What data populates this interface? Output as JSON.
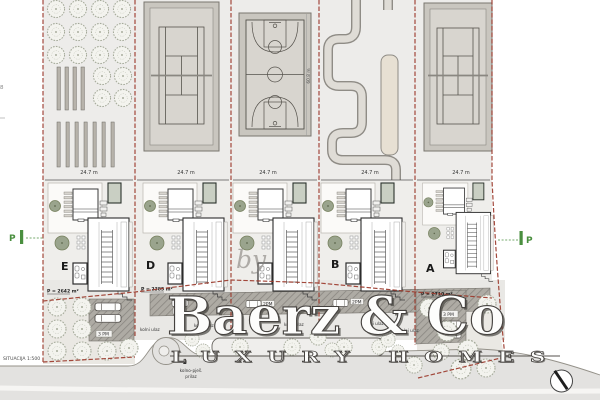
{
  "scale_label": "SITUACIJA 1:500",
  "dims": {
    "plot_width": "24.7 m",
    "court_depth": "60.8 m"
  },
  "plots": [
    {
      "id": "E",
      "label": "E",
      "area": "P = 2642 m²"
    },
    {
      "id": "D",
      "label": "D",
      "area": "P = 2385 m²"
    },
    {
      "id": "C",
      "label": "",
      "area": ""
    },
    {
      "id": "B",
      "label": "B",
      "area": ""
    },
    {
      "id": "A",
      "label": "A",
      "area": "P = 2710 m²"
    }
  ],
  "parking": {
    "marker": "P",
    "two": "2PM",
    "three": "3 PM"
  },
  "road_labels": {
    "driveway": "kolni ulaz",
    "access_1": "kolno-pješ.",
    "access_2": "prilaz"
  },
  "watermark": {
    "by": "by",
    "brand": "Baerz & Co",
    "tagline": "LUXURY HOMES"
  },
  "edge_fragment": "8",
  "colors": {
    "boundary_red": "#9c3a2c",
    "parking_green": "#4a8f3f",
    "tree_fill": "#9aa48d",
    "court_gray": "#c9c6bf",
    "court_inner": "#d8d5cf",
    "track_gray": "#dfdcd6",
    "road_gray": "#e3e2e0",
    "hatch_gray": "#aeaba4",
    "watermark_outline": "#45423f"
  }
}
